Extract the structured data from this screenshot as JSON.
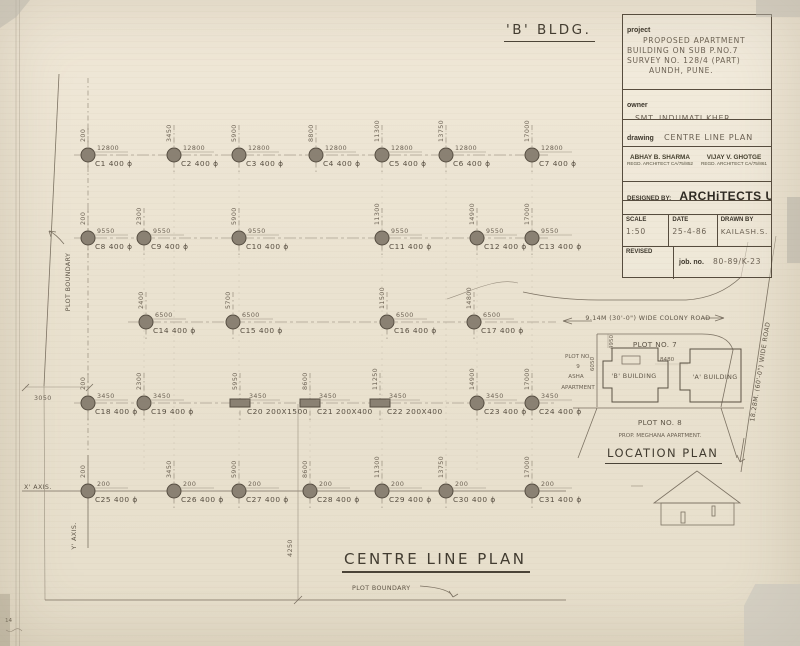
{
  "sheet": {
    "bldg_title": "'B' BLDG.",
    "plan_title": "CENTRE LINE PLAN",
    "x_axis_label": "X' AXIS.",
    "y_axis_label": "Y' AXIS.",
    "plot_boundary_left": "PLOT BOUNDARY",
    "plot_boundary_bottom": "PLOT BOUNDARY",
    "dim_3050": "3050",
    "dim_4250": "4250",
    "corner_note": "14"
  },
  "title_block": {
    "project_label": "project",
    "project_lines": [
      "PROPOSED APARTMENT",
      "BUILDING ON SUB P.NO.7",
      "SURVEY NO. 128/4 (PART)",
      "AUNDH, PUNE."
    ],
    "owner_label": "owner",
    "owner": "SMT. INDUMATI KHER.",
    "drawing_label": "drawing",
    "drawing": "CENTRE LINE PLAN",
    "architect1_name": "ABHAY B. SHARMA",
    "architect1_reg": "REGD. ARCHITECT CA/75/852",
    "architect2_name": "VIJAY V. GHOTGE",
    "architect2_reg": "REGD. ARCHITECT CA/75/861",
    "designed_by_label": "DESIGNED BY:",
    "firm": "ARCHiTECTS UNiTED",
    "address": "31/1, karve road, poona 411 004",
    "phone_icon": "●",
    "phone": "30226",
    "scale_label": "SCALE",
    "scale": "1:50",
    "date_label": "DATE",
    "date": "25-4-86",
    "drawn_label": "DRAWN BY",
    "drawn_by": "KAILASH.S.",
    "revised_label": "REVISED",
    "job_label": "job. no.",
    "job_no": "80-89/K-23",
    "drg_label": "drg.no.",
    "drg_no": "4808"
  },
  "plan": {
    "rows": [
      {
        "y": 155,
        "x1": 74,
        "x2": 548,
        "dim": "12800",
        "columns": [
          {
            "label": "C1",
            "size": "400 ϕ",
            "x": "200",
            "px": 88,
            "shape": "circle"
          },
          {
            "label": "C2",
            "size": "400 ϕ",
            "x": "3450",
            "px": 174,
            "shape": "circle"
          },
          {
            "label": "C3",
            "size": "400 ϕ",
            "x": "5900",
            "px": 239,
            "shape": "circle"
          },
          {
            "label": "C4",
            "size": "400 ϕ",
            "x": "8800",
            "px": 316,
            "shape": "circle"
          },
          {
            "label": "C5",
            "size": "400 ϕ",
            "x": "11300",
            "px": 382,
            "shape": "circle"
          },
          {
            "label": "C6",
            "size": "400 ϕ",
            "x": "13750",
            "px": 446,
            "shape": "circle"
          },
          {
            "label": "C7",
            "size": "400 ϕ",
            "x": "17000",
            "px": 532,
            "shape": "circle"
          }
        ]
      },
      {
        "y": 238,
        "x1": 74,
        "x2": 548,
        "dim": "9550",
        "columns": [
          {
            "label": "C8",
            "size": "400 ϕ",
            "x": "200",
            "px": 88,
            "shape": "circle"
          },
          {
            "label": "C9",
            "size": "400 ϕ",
            "x": "2300",
            "px": 144,
            "shape": "circle"
          },
          {
            "label": "C10",
            "size": "400 ϕ",
            "x": "5900",
            "px": 239,
            "shape": "circle"
          },
          {
            "label": "C11",
            "size": "400 ϕ",
            "x": "11300",
            "px": 382,
            "shape": "circle"
          },
          {
            "label": "C12",
            "size": "400 ϕ",
            "x": "14900",
            "px": 477,
            "shape": "circle"
          },
          {
            "label": "C13",
            "size": "400 ϕ",
            "x": "17000",
            "px": 532,
            "shape": "circle"
          }
        ]
      },
      {
        "y": 322,
        "x1": 128,
        "x2": 556,
        "dim": "6500",
        "columns": [
          {
            "label": "C14",
            "size": "400 ϕ",
            "x": "2400",
            "px": 146,
            "shape": "circle"
          },
          {
            "label": "C15",
            "size": "400 ϕ",
            "x": "5700",
            "px": 233,
            "shape": "circle"
          },
          {
            "label": "C16",
            "size": "400 ϕ",
            "x": "11500",
            "px": 387,
            "shape": "circle"
          },
          {
            "label": "C17",
            "size": "400 ϕ",
            "x": "14800",
            "px": 474,
            "shape": "circle"
          }
        ]
      },
      {
        "y": 403,
        "x1": 74,
        "x2": 556,
        "dim": "3450",
        "columns": [
          {
            "label": "C18",
            "size": "400 ϕ",
            "x": "200",
            "px": 88,
            "shape": "circle"
          },
          {
            "label": "C19",
            "size": "400 ϕ",
            "x": "2300",
            "px": 144,
            "shape": "circle"
          },
          {
            "label": "C20",
            "size": "200X1500",
            "x": "5950",
            "px": 240,
            "shape": "rect"
          },
          {
            "label": "C21",
            "size": "200X400",
            "x": "8600",
            "px": 310,
            "shape": "rect"
          },
          {
            "label": "C22",
            "size": "200X400",
            "x": "11250",
            "px": 380,
            "shape": "rect"
          },
          {
            "label": "C23",
            "size": "400 ϕ",
            "x": "14900",
            "px": 477,
            "shape": "circle"
          },
          {
            "label": "C24",
            "size": "400 ϕ",
            "x": "17000",
            "px": 532,
            "shape": "circle"
          }
        ]
      },
      {
        "y": 491,
        "x1": null,
        "x2": null,
        "dim": "200",
        "columns": [
          {
            "label": "C25",
            "size": "400 ϕ",
            "x": "200",
            "px": 88,
            "shape": "circle"
          },
          {
            "label": "C26",
            "size": "400 ϕ",
            "x": "3450",
            "px": 174,
            "shape": "circle"
          },
          {
            "label": "C27",
            "size": "400 ϕ",
            "x": "5900",
            "px": 239,
            "shape": "circle"
          },
          {
            "label": "C28",
            "size": "400 ϕ",
            "x": "8600",
            "px": 310,
            "shape": "circle"
          },
          {
            "label": "C29",
            "size": "400 ϕ",
            "x": "11300",
            "px": 382,
            "shape": "circle"
          },
          {
            "label": "C30",
            "size": "400 ϕ",
            "x": "13750",
            "px": 446,
            "shape": "circle"
          },
          {
            "label": "C31",
            "size": "400 ϕ",
            "x": "17000",
            "px": 532,
            "shape": "circle"
          }
        ]
      }
    ]
  },
  "location": {
    "title": "LOCATION PLAN",
    "colony_road": "9.14M (30'-0\") WIDE COLONY ROAD",
    "wide_road": "18.28M. (60'-0\") WIDE ROAD",
    "plot7": "PLOT NO. 7",
    "plot9_line1": "PLOT NO.",
    "plot9_line2": "9",
    "plot9_line3": "ASHA",
    "plot9_line4": "APARTMENT",
    "b_building": "'B' BUILDING",
    "a_building": "'A' BUILDING",
    "plot8": "PLOT NO. 8",
    "plot8_sub": "PROP. MEGHANA APARTMENT.",
    "dim_8480": "8480",
    "dim_4950": "4950",
    "dim_6050": "6050"
  }
}
